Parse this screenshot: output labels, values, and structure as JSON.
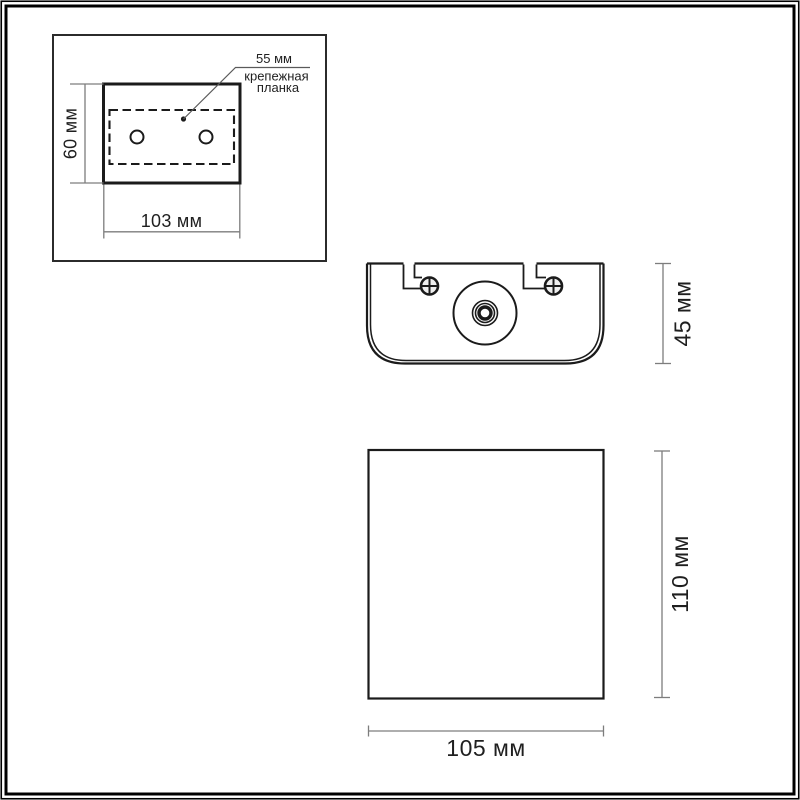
{
  "diagram": {
    "type": "product-dimension-drawing",
    "inset": {
      "callout_value": "55 мм",
      "callout_line1": "крепежная",
      "callout_line2": "планка",
      "dim_height": "60 мм",
      "dim_width": "103 мм"
    },
    "top_view": {
      "dim_height": "45 мм"
    },
    "front_view": {
      "dim_height": "110 мм",
      "dim_width": "105 мм"
    }
  },
  "colors": {
    "background": "#ffffff",
    "outline": "#1b1b1b",
    "dimension_line": "#7d7d7d",
    "text": "#1f1f1f"
  }
}
